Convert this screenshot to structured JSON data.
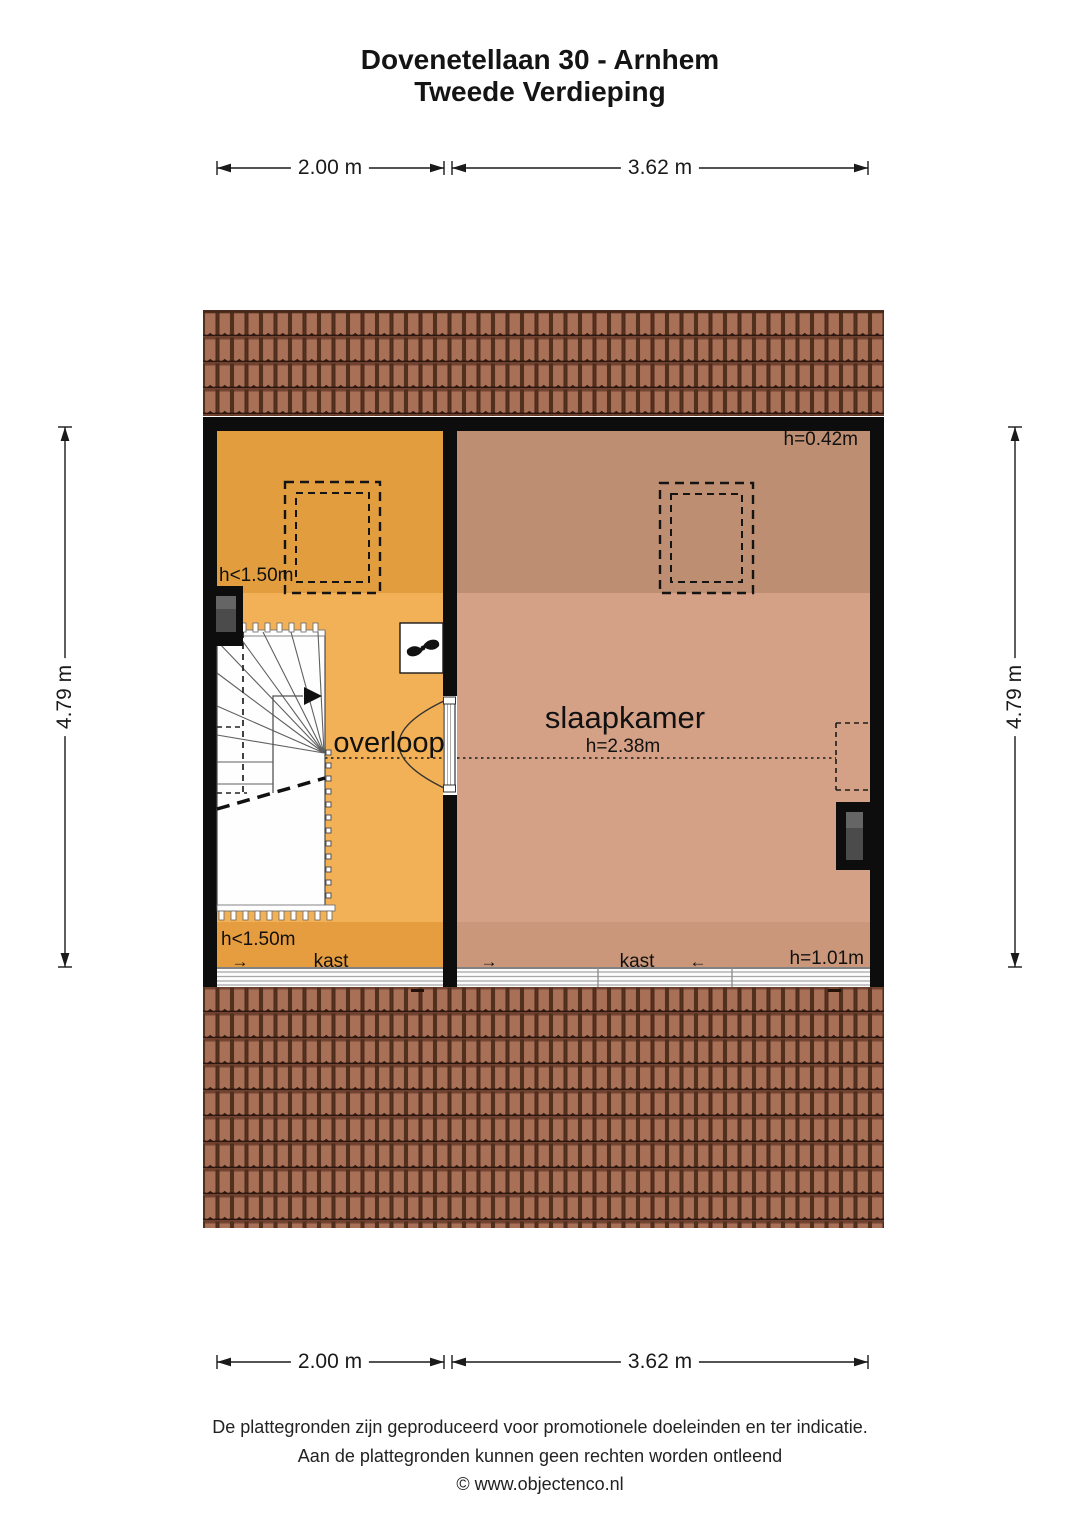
{
  "title": {
    "line1": "Dovenetellaan 30 - Arnhem",
    "line2": "Tweede Verdieping"
  },
  "dimensions": {
    "top_left": "2.00 m",
    "top_right": "3.62 m",
    "bottom_left": "2.00 m",
    "bottom_right": "3.62 m",
    "side_left": "4.79 m",
    "side_right": "4.79 m"
  },
  "rooms": {
    "overloop": {
      "label": "overloop",
      "height_zone_top": "h<1.50m",
      "height_zone_bottom": "h<1.50m",
      "closet_arrow": "→",
      "closet_label": "kast"
    },
    "slaapkamer": {
      "label": "slaapkamer",
      "ceiling_height": "h=2.38m",
      "height_top_right": "h=0.42m",
      "height_bottom_right": "h=1.01m",
      "closet_arrow_left": "→",
      "closet_label": "kast",
      "closet_arrow_right": "←"
    }
  },
  "footer": {
    "line1": "De plattegronden zijn geproduceerd voor promotionele doeleinden en ter indicatie.",
    "line2": "Aan de plattegronden kunnen geen rechten worden ontleend",
    "line3": "© www.objectenco.nl"
  },
  "colors": {
    "overloop_light": "#f3b157",
    "overloop_dark": "#e29e3e",
    "overloop_bottom": "#e59d3f",
    "slaapkamer_light": "#d4a187",
    "slaapkamer_dark": "#bd8e72",
    "slaapkamer_bottom": "#cb977a",
    "wall": "#0d0d0d",
    "roof_base": "#9a6148",
    "window_glass": "#4b4b4b"
  }
}
